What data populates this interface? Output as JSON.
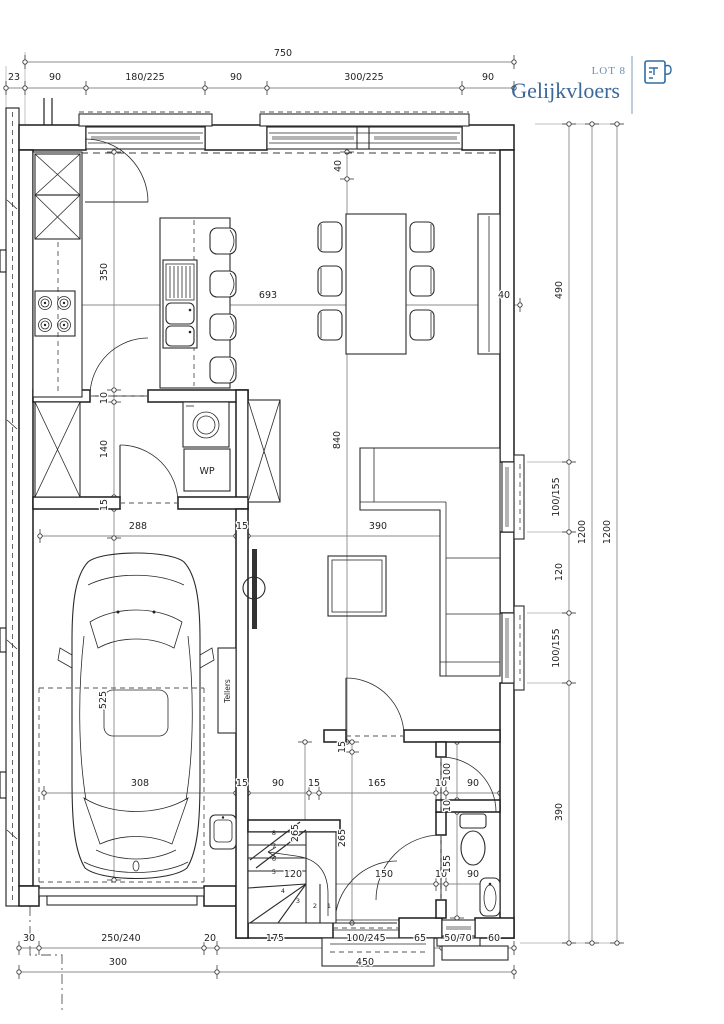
{
  "header": {
    "lot_label": "LOT 8",
    "floor_label": "Gelijkvloers",
    "icon": "floorplan-icon",
    "lot_color": "#6a8fb4",
    "floor_color": "#3a689a",
    "divider_color": "#a9c0d6",
    "icon_color": "#2e6da4"
  },
  "fixtures": {
    "heat_pump_label": "WP",
    "meter_cabinet_label": "Tellers"
  },
  "stairs": {
    "step_numbers": [
      "1",
      "2",
      "3",
      "4",
      "5",
      "6",
      "7",
      "8"
    ]
  },
  "dimension_labels": [
    {
      "t": "750",
      "x": 283,
      "y": 56
    },
    {
      "t": "23",
      "x": 14,
      "y": 80
    },
    {
      "t": "90",
      "x": 55,
      "y": 80
    },
    {
      "t": "180/225",
      "x": 145,
      "y": 80
    },
    {
      "t": "90",
      "x": 236,
      "y": 80
    },
    {
      "t": "300/225",
      "x": 364,
      "y": 80
    },
    {
      "t": "90",
      "x": 488,
      "y": 80
    },
    {
      "t": "30",
      "x": 29,
      "y": 941
    },
    {
      "t": "250/240",
      "x": 121,
      "y": 941
    },
    {
      "t": "20",
      "x": 210,
      "y": 941
    },
    {
      "t": "175",
      "x": 275,
      "y": 941
    },
    {
      "t": "100/245",
      "x": 366,
      "y": 941
    },
    {
      "t": "65",
      "x": 420,
      "y": 941
    },
    {
      "t": "50/70",
      "x": 458,
      "y": 941
    },
    {
      "t": "60",
      "x": 494,
      "y": 941
    },
    {
      "t": "300",
      "x": 118,
      "y": 965
    },
    {
      "t": "450",
      "x": 365,
      "y": 965
    },
    {
      "t": "490",
      "x": 562,
      "y": 290,
      "r": -90
    },
    {
      "t": "100/155",
      "x": 559,
      "y": 497,
      "r": -90
    },
    {
      "t": "120",
      "x": 562,
      "y": 572,
      "r": -90
    },
    {
      "t": "100/155",
      "x": 559,
      "y": 648,
      "r": -90
    },
    {
      "t": "390",
      "x": 562,
      "y": 812,
      "r": -90
    },
    {
      "t": "1200",
      "x": 585,
      "y": 532,
      "r": -90
    },
    {
      "t": "1200",
      "x": 610,
      "y": 532,
      "r": -90
    },
    {
      "t": "693",
      "x": 268,
      "y": 298
    },
    {
      "t": "40",
      "x": 504,
      "y": 298
    },
    {
      "t": "350",
      "x": 107,
      "y": 272,
      "r": -90
    },
    {
      "t": "10",
      "x": 107,
      "y": 398,
      "r": -90
    },
    {
      "t": "140",
      "x": 107,
      "y": 449,
      "r": -90
    },
    {
      "t": "15",
      "x": 107,
      "y": 505,
      "r": -90
    },
    {
      "t": "525",
      "x": 106,
      "y": 700,
      "r": -90
    },
    {
      "t": "40",
      "x": 341,
      "y": 166,
      "r": -90
    },
    {
      "t": "840",
      "x": 340,
      "y": 440,
      "r": -90
    },
    {
      "t": "288",
      "x": 138,
      "y": 529
    },
    {
      "t": "15",
      "x": 242,
      "y": 529
    },
    {
      "t": "390",
      "x": 378,
      "y": 529
    },
    {
      "t": "308",
      "x": 140,
      "y": 786
    },
    {
      "t": "15",
      "x": 242,
      "y": 786
    },
    {
      "t": "90",
      "x": 278,
      "y": 786
    },
    {
      "t": "15",
      "x": 314,
      "y": 786
    },
    {
      "t": "165",
      "x": 377,
      "y": 786
    },
    {
      "t": "10",
      "x": 441,
      "y": 786
    },
    {
      "t": "90",
      "x": 473,
      "y": 786
    },
    {
      "t": "120",
      "x": 293,
      "y": 877
    },
    {
      "t": "150",
      "x": 384,
      "y": 877
    },
    {
      "t": "10",
      "x": 441,
      "y": 877
    },
    {
      "t": "90",
      "x": 473,
      "y": 877
    },
    {
      "t": "15",
      "x": 345,
      "y": 747,
      "r": -90
    },
    {
      "t": "265",
      "x": 345,
      "y": 838,
      "r": -90
    },
    {
      "t": "265",
      "x": 298,
      "y": 833,
      "r": -90
    },
    {
      "t": "100",
      "x": 450,
      "y": 772,
      "r": -90
    },
    {
      "t": "10",
      "x": 450,
      "y": 806,
      "r": -90
    },
    {
      "t": "155",
      "x": 450,
      "y": 864,
      "r": -90
    }
  ]
}
